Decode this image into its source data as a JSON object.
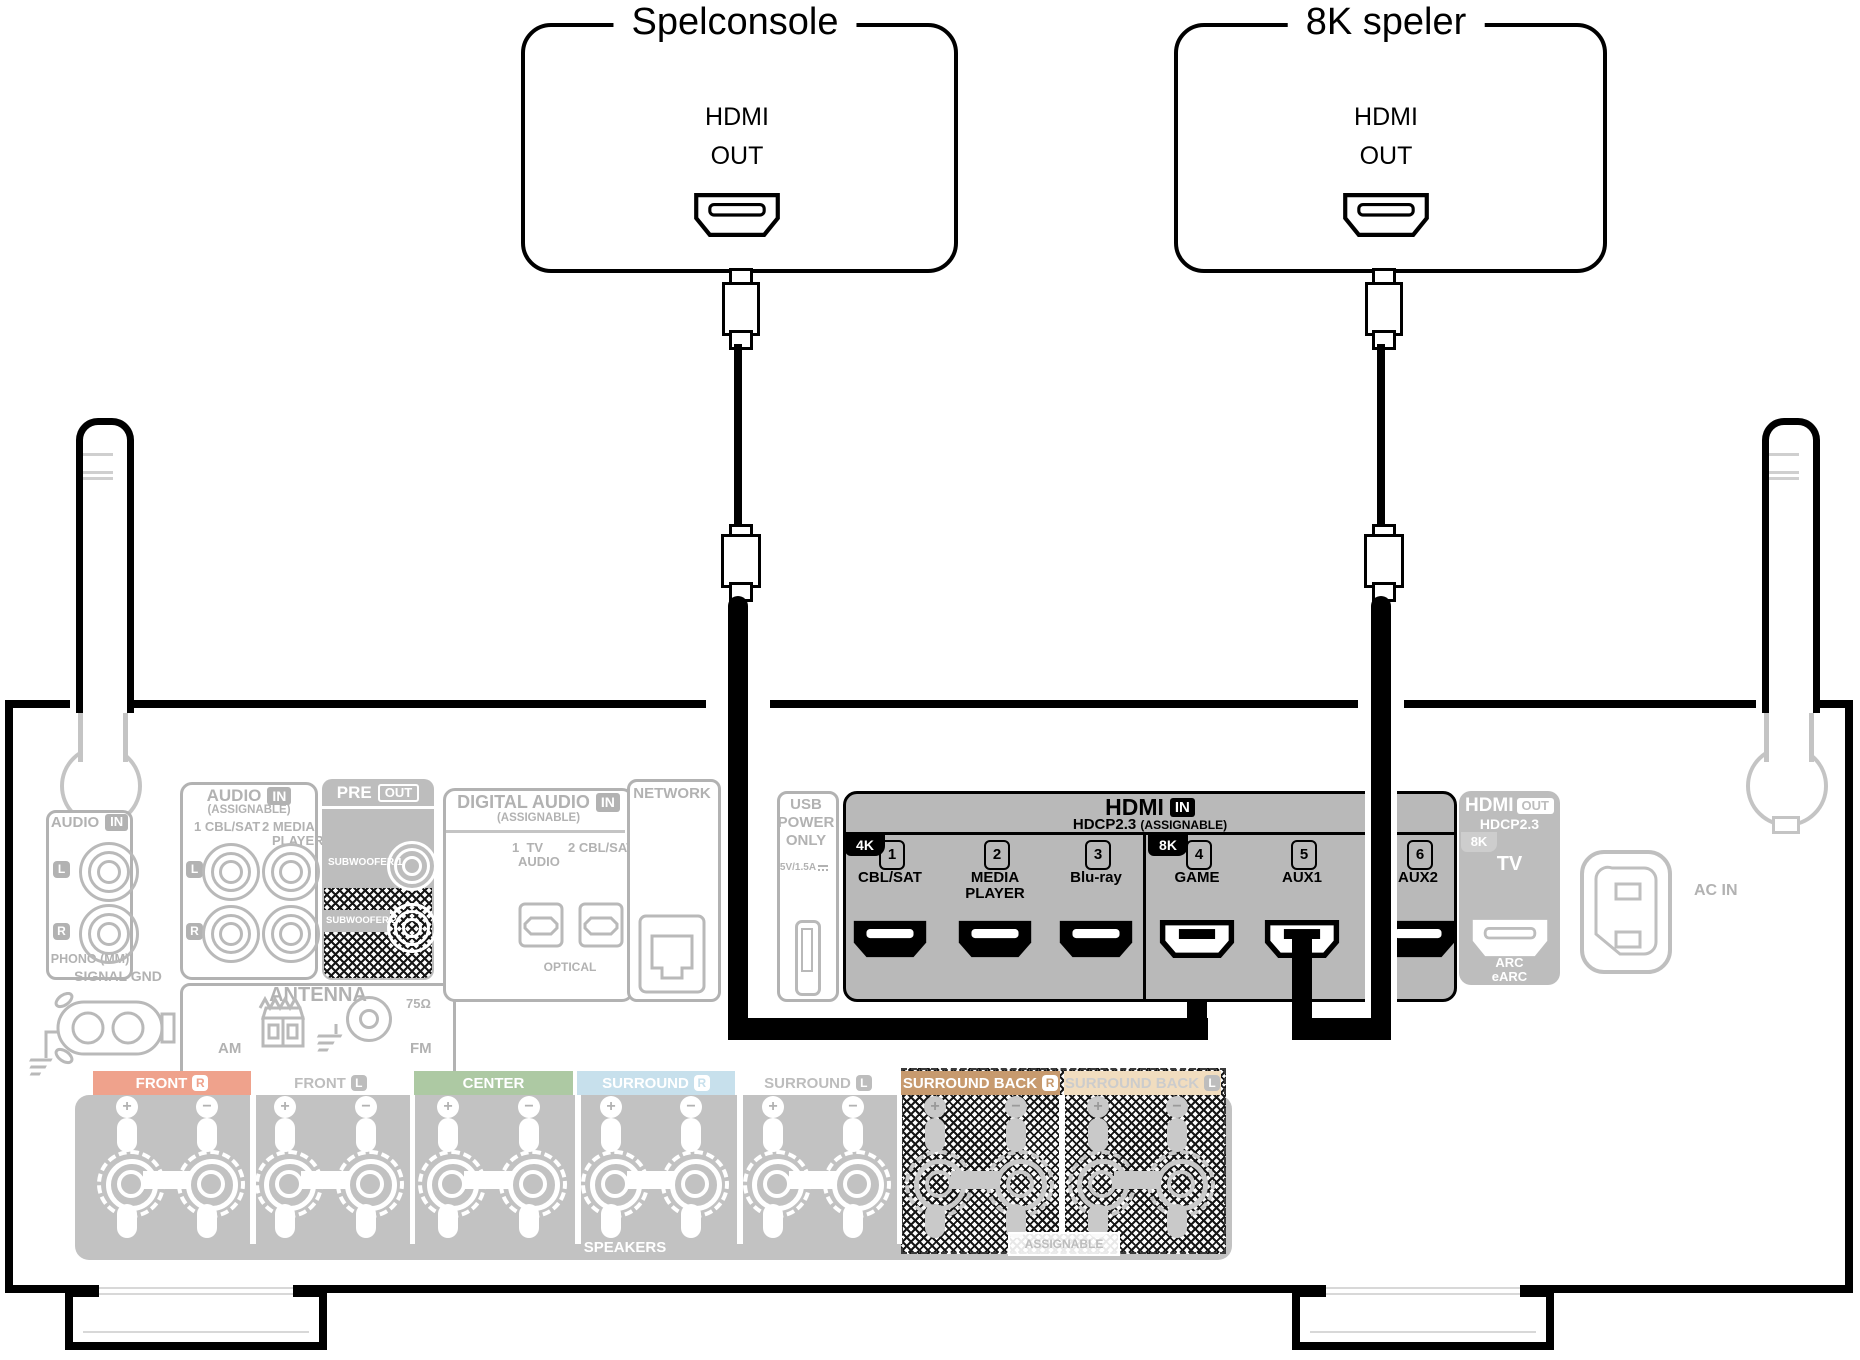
{
  "palette": {
    "highlight": "#000000",
    "inactive": "#b2b2b2",
    "panel_fill": "#c2c2c2",
    "hdmi_in_fill": "#b9b9b9"
  },
  "devices": [
    {
      "title": "Spelconsole",
      "port": {
        "line1": "HDMI",
        "line2": "OUT"
      }
    },
    {
      "title": "8K speler",
      "port": {
        "line1": "HDMI",
        "line2": "OUT"
      }
    }
  ],
  "rear_panel": {
    "audio_in_phono": {
      "title": "AUDIO",
      "badge": "IN",
      "channel_left": "L",
      "channel_right": "R",
      "caption": "PHONO (MM)"
    },
    "signal_gnd": {
      "label": "SIGNAL GND"
    },
    "audio_in_assignable": {
      "title": "AUDIO",
      "badge": "IN",
      "subtitle": "(ASSIGNABLE)",
      "input1": "1 CBL/SAT",
      "input2_line1": "2 MEDIA",
      "input2_line2": "PLAYER",
      "channel_left": "L",
      "channel_right": "R"
    },
    "pre_out": {
      "title": "PRE",
      "badge": "OUT",
      "sub1": "SUBWOOFER 1",
      "sub2": "SUBWOOFER 2"
    },
    "antenna": {
      "title": "ANTENNA",
      "am": "AM",
      "fm": "FM",
      "ohm": "75Ω"
    },
    "digital_audio": {
      "title": "DIGITAL AUDIO",
      "badge": "IN",
      "subtitle": "(ASSIGNABLE)",
      "input1_line1": "1  TV",
      "input1_line2": "AUDIO",
      "input2": "2 CBL/SAT",
      "caption": "OPTICAL"
    },
    "network": {
      "title": "NETWORK"
    },
    "usb": {
      "line1": "USB",
      "line2": "POWER",
      "line3": "ONLY",
      "rating": "5V/1.5A"
    },
    "hdmi_in": {
      "title": "HDMI",
      "badge": "IN",
      "hdcp": "HDCP2.3",
      "assignable": "(ASSIGNABLE)",
      "tab_4k": "4K",
      "tab_8k": "8K",
      "ports": [
        {
          "num": "1",
          "label": "CBL/SAT",
          "connected": false
        },
        {
          "num": "2",
          "label": "MEDIA\nPLAYER",
          "connected": false
        },
        {
          "num": "3",
          "label": "Blu-ray",
          "connected": false
        },
        {
          "num": "4",
          "label": "GAME",
          "connected": true
        },
        {
          "num": "5",
          "label": "AUX1",
          "connected": true
        },
        {
          "num": "6",
          "label": "AUX2",
          "connected": false
        }
      ]
    },
    "hdmi_out": {
      "title": "HDMI",
      "badge": "OUT",
      "hdcp": "HDCP2.3",
      "tab_8k": "8K",
      "port_label": "TV",
      "arc_line1": "ARC",
      "arc_line2": "eARC"
    },
    "ac_in": {
      "label": "AC IN"
    }
  },
  "speakers": {
    "sections": [
      {
        "label": "FRONT",
        "channel": "R",
        "bg": "#efa28c",
        "fg": "#ffffff",
        "badge_style": "white",
        "zone": "normal"
      },
      {
        "label": "FRONT",
        "channel": "L",
        "bg": "#ffffff",
        "fg": "#bdbdbd",
        "badge_style": "gray",
        "zone": "normal"
      },
      {
        "label": "CENTER",
        "channel": "",
        "bg": "#adc9a3",
        "fg": "#ffffff",
        "badge_style": "none",
        "zone": "normal"
      },
      {
        "label": "SURROUND",
        "channel": "R",
        "bg": "#c7e0ec",
        "fg": "#ffffff",
        "badge_style": "white",
        "zone": "normal"
      },
      {
        "label": "SURROUND",
        "channel": "L",
        "bg": "#ffffff",
        "fg": "#bdbdbd",
        "badge_style": "gray",
        "zone": "normal"
      },
      {
        "label": "SURROUND BACK",
        "channel": "R",
        "bg": "#c79a6e",
        "fg": "#ffffff",
        "badge_style": "white",
        "zone": "assignable"
      },
      {
        "label": "SURROUND BACK",
        "channel": "L",
        "bg": "#f1ddbf",
        "fg": "#cccccc",
        "badge_style": "gray",
        "zone": "assignable"
      }
    ],
    "assignable_label": "ASSIGNABLE",
    "footer": "SPEAKERS"
  }
}
